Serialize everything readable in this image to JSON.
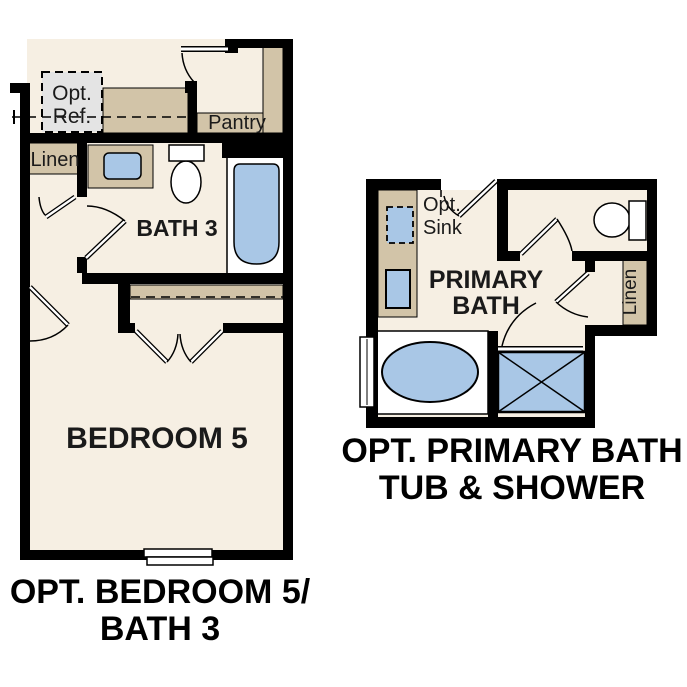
{
  "colors": {
    "floor": "#f6efe3",
    "cabinet_tan": "#d2c4a8",
    "fixture_blue": "#a9c7e6",
    "ref_gray": "#e4e4e4",
    "wall": "#000000",
    "fixture_white": "#ffffff"
  },
  "left_plan": {
    "caption": [
      "OPT. BEDROOM 5/",
      "BATH 3"
    ],
    "labels": {
      "opt_ref": [
        "Opt.",
        "Ref."
      ],
      "linen": "Linen",
      "pantry": "Pantry",
      "bath": "BATH 3",
      "bedroom": "BEDROOM 5"
    }
  },
  "right_plan": {
    "caption": [
      "OPT. PRIMARY BATH",
      "TUB & SHOWER"
    ],
    "labels": {
      "opt_sink": [
        "Opt.",
        "Sink"
      ],
      "primary": [
        "PRIMARY",
        "BATH"
      ],
      "linen": "Linen"
    }
  }
}
